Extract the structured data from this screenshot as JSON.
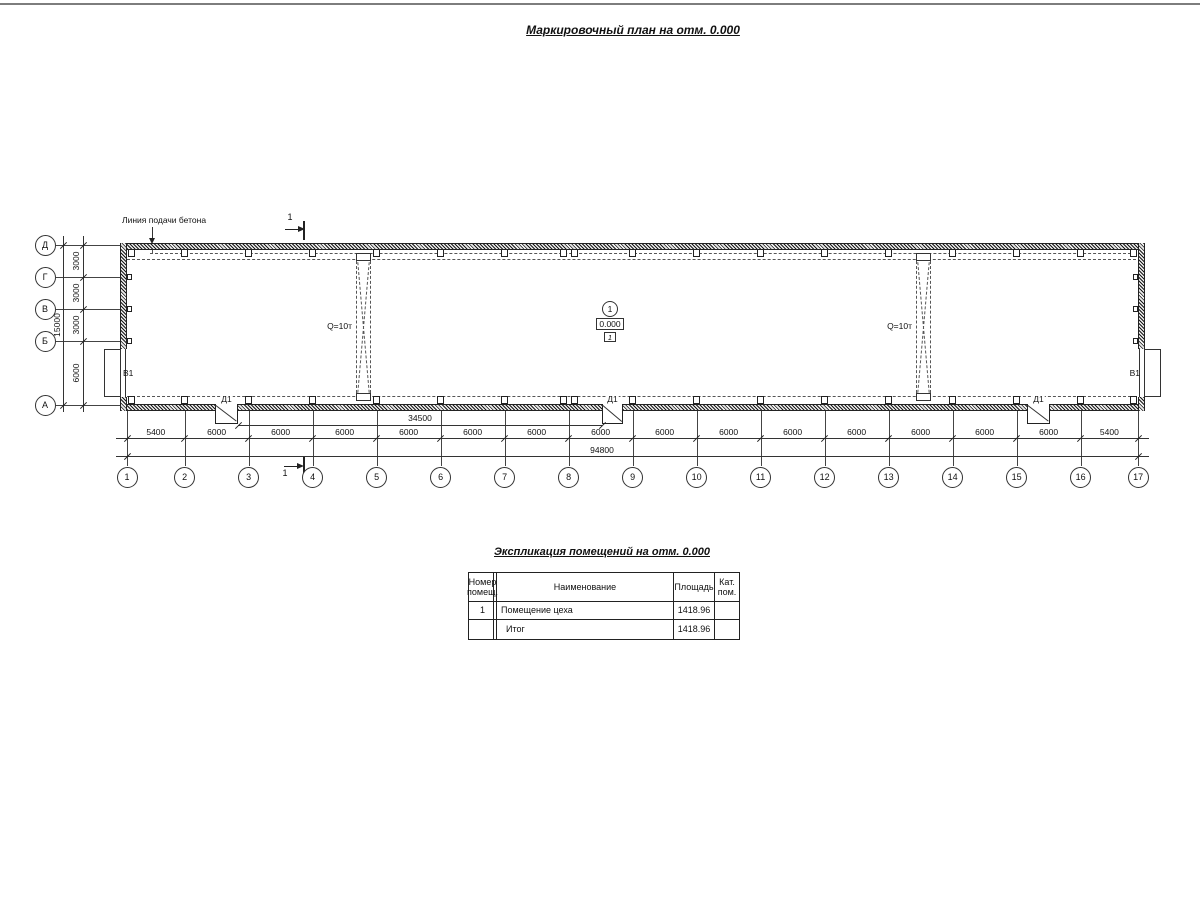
{
  "page": {
    "title": "Маркировочный план на отм. 0.000"
  },
  "plan": {
    "concrete_line_label": "Линия подачи бетона",
    "section_label": "1",
    "crane_label": "Q=10т",
    "door_label": "Д1",
    "gate_label": "В1",
    "room_mark": {
      "number": "1",
      "elevation": "0.000",
      "floor_type": "1"
    },
    "axes": {
      "vertical_letters": [
        "Д",
        "Г",
        "В",
        "Б",
        "А"
      ],
      "vertical_dims": [
        "3000",
        "3000",
        "3000",
        "6000"
      ],
      "vertical_total": "15000",
      "horizontal_numbers": [
        "1",
        "2",
        "3",
        "4",
        "5",
        "6",
        "7",
        "8",
        "9",
        "10",
        "11",
        "12",
        "13",
        "14",
        "15",
        "16",
        "17"
      ],
      "horizontal_dims": [
        "5400",
        "6000",
        "6000",
        "6000",
        "6000",
        "6000",
        "6000",
        "6000",
        "6000",
        "6000",
        "6000",
        "6000",
        "6000",
        "6000",
        "6000",
        "5400"
      ],
      "horizontal_total": "94800",
      "partial_dim": "34500"
    }
  },
  "table": {
    "title": "Экспликация помещений на отм. 0.000",
    "headers": [
      "Номер помещ.",
      "Наименование",
      "Площадь",
      "Кат. пом."
    ],
    "rows": [
      [
        "1",
        "Помещение цеха",
        "1418.96",
        ""
      ],
      [
        "",
        "Итог",
        "1418.96",
        ""
      ]
    ]
  }
}
